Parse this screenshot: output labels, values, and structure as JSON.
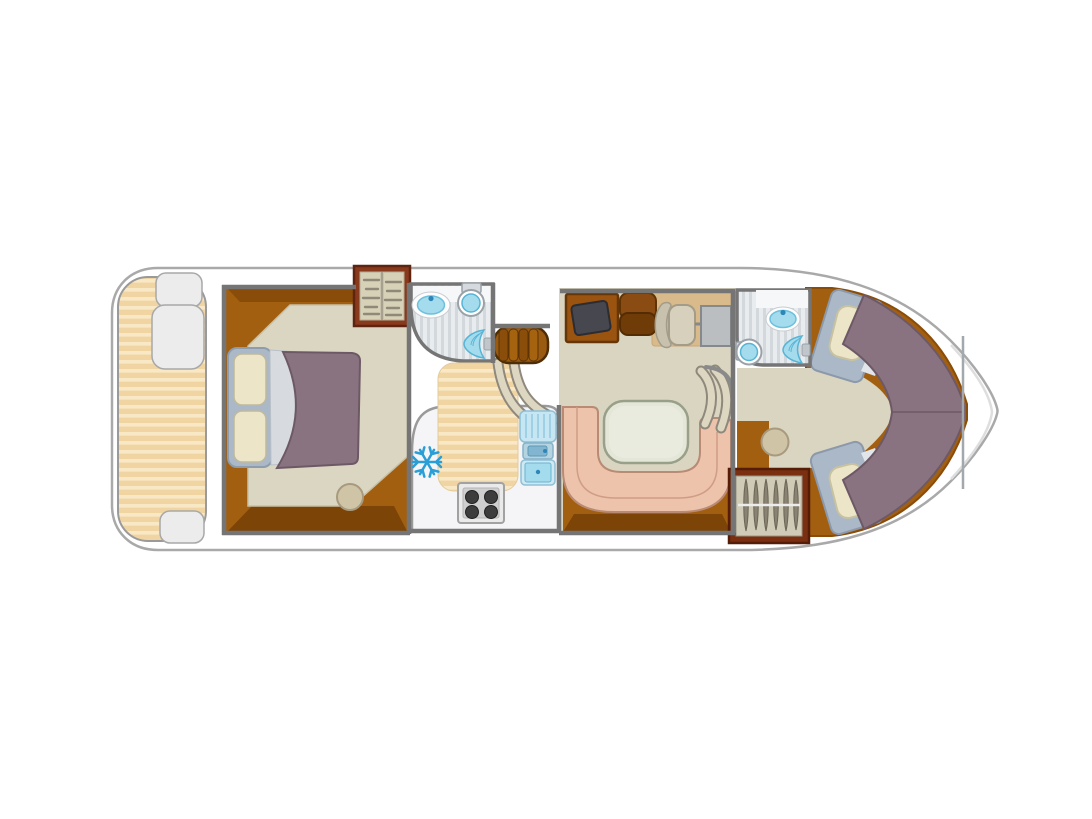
{
  "diagram": {
    "type": "boat-floorplan",
    "view": "top-down",
    "regions": [
      {
        "name": "aft-sun-deck",
        "features": [
          "slatted-deck",
          "boarding-steps"
        ]
      },
      {
        "name": "master-cabin",
        "features": [
          "double-bed",
          "two-pillows",
          "wardrobe-with-shelves",
          "stool"
        ]
      },
      {
        "name": "aft-bathroom",
        "features": [
          "washbasin",
          "toilet",
          "shower"
        ]
      },
      {
        "name": "companionway",
        "features": [
          "five-tread-stairs",
          "curved-handrails",
          "slatted-walkway"
        ]
      },
      {
        "name": "galley",
        "features": [
          "refrigerator",
          "four-burner-stove",
          "sink-with-drainer"
        ]
      },
      {
        "name": "saloon",
        "features": [
          "chart-screen-desk",
          "bench-seat",
          "helm-seat",
          "helm-console",
          "u-shaped-dinette",
          "table",
          "steps-to-bow"
        ]
      },
      {
        "name": "forward-bathroom",
        "features": [
          "washbasin",
          "toilet",
          "shower"
        ]
      },
      {
        "name": "forward-cabin",
        "features": [
          "v-berth-port",
          "v-berth-starboard",
          "wardrobe-with-hangers",
          "stool"
        ]
      },
      {
        "name": "bow-deck",
        "features": []
      }
    ],
    "counts": {
      "stove_burners": 4,
      "stair_treads": 5,
      "wardrobe_hangers": 6,
      "berths": 4,
      "bathrooms": 2
    }
  },
  "icons": [
    {
      "name": "snowflake-icon",
      "meaning": "refrigerator"
    }
  ],
  "colors": {
    "hull_fill": "#ffffff",
    "hull_stroke": "#a9a9a9",
    "deck_base": "#f0d5a2",
    "deck_stripe": "#f9e8c6",
    "wood": "#a35f10",
    "wood_dark": "#7c4407",
    "carpet": "#dbd6c1",
    "saloon_floor": "#dad5c0",
    "wall": "#757575",
    "bed_frame": "#aab8c8",
    "pillow": "#ece5c8",
    "blanket": "#8a7380",
    "blanket_edge": "#6d5966",
    "tile_base": "#e9ecee",
    "tile_stripe": "#d3d8dc",
    "fixture_blue": "#a4dcee",
    "fixture_deep": "#58b4d4",
    "stairs_brown": "#9a5a10",
    "rail": "#ddd7c2",
    "galley_counter": "#f5f5f7",
    "burner": "#3d3d3d",
    "fridge_snowflake": "#2a9ed6",
    "helm_mat": "#d9ba8a",
    "helm_screen": "#47474f",
    "dinette_seat": "#eec3ab",
    "dinette_table": "#e4e7d8",
    "wardrobe_fill": "#d7d1b8",
    "wardrobe_frame": "#8a3a1c",
    "stool": "#cfc4a6"
  }
}
